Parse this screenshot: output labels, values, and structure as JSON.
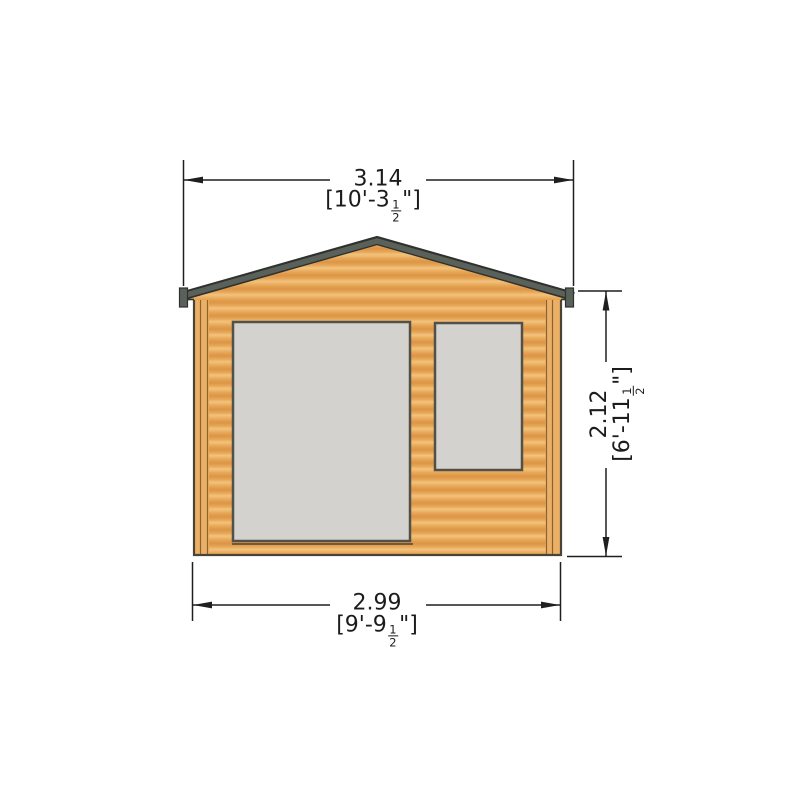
{
  "drawing": {
    "subject": "log cabin front elevation technical drawing",
    "view": "front elevation",
    "colors": {
      "wood_light": "#f2c37d",
      "wood_mid": "#e8a757",
      "wood_dark": "#db9546",
      "post_wood": "#ebb066",
      "post_line": "#8a6234",
      "fascia": "#59615a",
      "fascia_edge": "#2f312d",
      "glazing": "#d3d2ce",
      "frame": "#53504a",
      "outline": "#4a4438",
      "dimension": "#1f1f1f",
      "background": "#ffffff"
    }
  },
  "dimensions": {
    "overall_width": {
      "metric": "3.14",
      "imperial_prefix": "[10'-3",
      "fraction_numerator": "1",
      "fraction_denominator": "2",
      "imperial_suffix": "\"]"
    },
    "base_width": {
      "metric": "2.99",
      "imperial_prefix": "[9'-9",
      "fraction_numerator": "1",
      "fraction_denominator": "2",
      "imperial_suffix": "\"]"
    },
    "wall_height": {
      "metric": "2.12",
      "imperial_prefix": "[6'-11",
      "fraction_numerator": "1",
      "fraction_denominator": "2",
      "imperial_suffix": "\"]"
    }
  }
}
